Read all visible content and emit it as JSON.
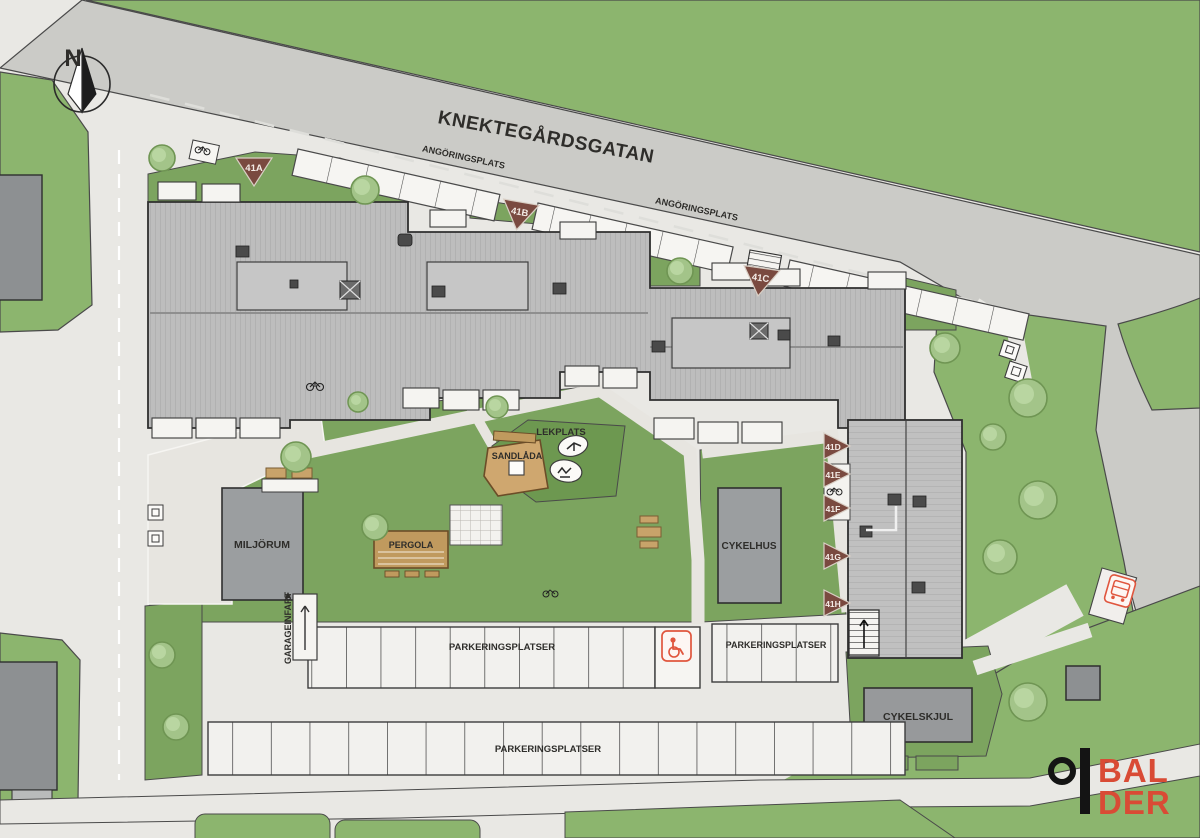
{
  "street": {
    "name": "KNEKTEGÅRDSGATAN"
  },
  "labels": {
    "angoringsplats_1": "ANGÖRINGSPLATS",
    "angoringsplats_2": "ANGÖRINGSPLATS",
    "lekplats": "LEKPLATS",
    "sandlada": "SANDLÅDA",
    "miljorum": "MILJÖRUM",
    "pergola": "PERGOLA",
    "cykelhus": "CYKELHUS",
    "cykelskjul": "CYKELSKJUL",
    "garageinfart": "GARAGEINFART",
    "parkering_row1_a": "PARKERINGSPLATSER",
    "parkering_row1_b": "PARKERINGSPLATSER",
    "parkering_row2": "PARKERINGSPLATSER",
    "north": "N"
  },
  "entrance_markers": [
    {
      "label": "41A"
    },
    {
      "label": "41B"
    },
    {
      "label": "41C"
    },
    {
      "label": "41D"
    },
    {
      "label": "41E"
    },
    {
      "label": "41F"
    },
    {
      "label": "41G"
    },
    {
      "label": "41H"
    }
  ],
  "logo": {
    "line1": "BAL",
    "line2": "DER"
  },
  "icons": [
    "north-arrow-icon",
    "bicycle-icon",
    "handicap-parking-icon",
    "bus-stop-icon",
    "stairs-icon",
    "tree-icon",
    "bench-icon",
    "play-equipment-icon",
    "balder-logo"
  ],
  "colors": {
    "road_dark": "#cbcbc7",
    "paving_light": "#e9e8e4",
    "green_outer": "#8cb56e",
    "green_lawn": "#7ca45f",
    "green_play": "#6d9850",
    "roof_gray": "#bdbdbd",
    "building_gray": "#9b9ea0",
    "marker_maroon": "#7a4a40",
    "sand_tan": "#cfa76f",
    "pergola_tan": "#c09a5e",
    "accent_red": "#d94b35",
    "text_dark": "#2e2d2a"
  }
}
